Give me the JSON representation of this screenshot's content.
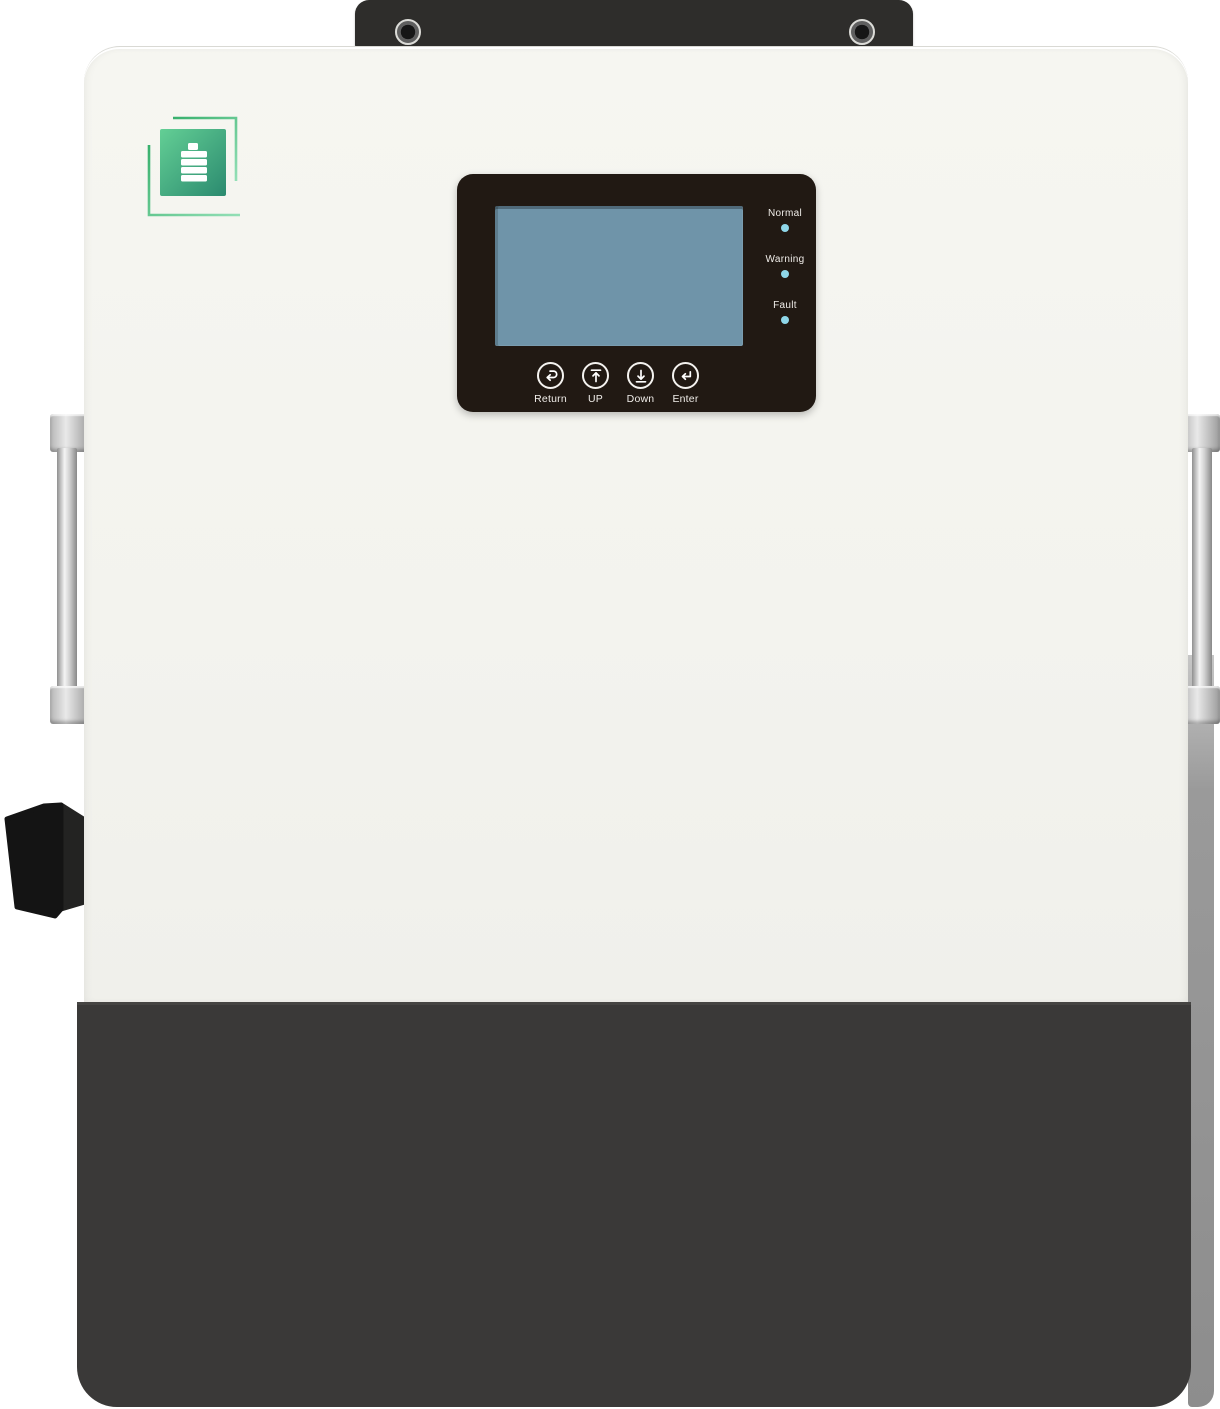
{
  "device": {
    "type": "energy-storage-inverter-front-view",
    "logo": {
      "icon": "battery-icon",
      "square_gradient_start": "#5fcd92",
      "square_gradient_end": "#2b8a6f",
      "frame_line_color": "#3eb974"
    },
    "control_panel": {
      "screen_style": "background:#6f94a9",
      "led_dot_style": "background:#8fd7e9",
      "leds": [
        {
          "label": "Normal"
        },
        {
          "label": "Warning"
        },
        {
          "label": "Fault"
        }
      ],
      "buttons": [
        {
          "label": "Return",
          "icon": "return-arrow-icon"
        },
        {
          "label": "UP",
          "icon": "up-arrow-icon"
        },
        {
          "label": "Down",
          "icon": "down-arrow-icon"
        },
        {
          "label": "Enter",
          "icon": "enter-arrow-icon"
        }
      ]
    },
    "colors": {
      "body": "#f4f4ef",
      "bottom_section": "#3a3938",
      "mount_bracket": "#2e2d2b",
      "panel": "#211913",
      "screen": "#6f94a9",
      "led_dot": "#8fd7e9",
      "logo_green": "#3eb974",
      "handle_silver": "#cfcfcf",
      "connector_black": "#141414"
    }
  }
}
